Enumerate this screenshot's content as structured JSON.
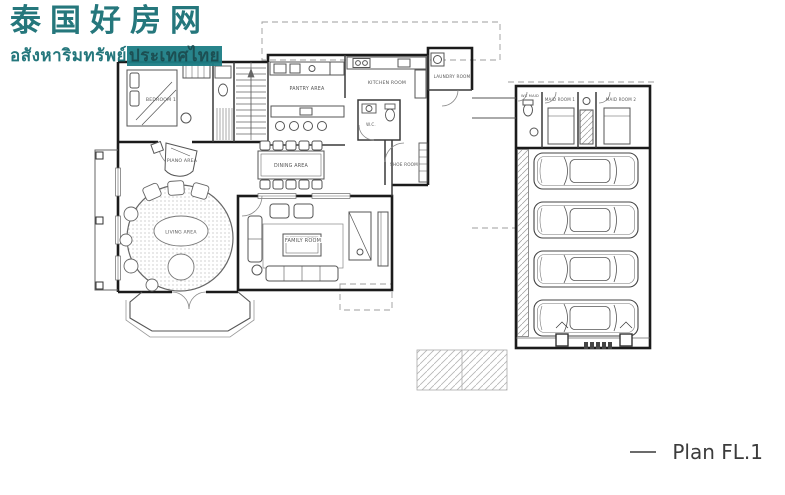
{
  "watermark": {
    "title_cn": "泰国好房网",
    "subtitle_th_plain": "อสังหาริมทรัพย์",
    "subtitle_th_highlight": "ประเทศไทย"
  },
  "colors": {
    "accent_teal": "#1a7076",
    "wall_line": "#1b1b1b",
    "room_label": "#555555"
  },
  "plan": {
    "label": "Plan FL.1",
    "rooms": {
      "bedroom": "BEDROOM 1",
      "pantry": "PANTRY AREA",
      "kitchen": "KITCHEN ROOM",
      "laundry": "LAUNDRY ROOM",
      "bath": "W.C.",
      "shoe": "SHOE ROOM",
      "wc_maid": "WC MAID",
      "maid1": "MAID ROOM 1",
      "maid2": "MAID ROOM 2",
      "dining": "DINING AREA",
      "piano": "PIANO AREA",
      "living": "LIVING AREA",
      "family": "FAMILY ROOM"
    },
    "garage_car_count": "4"
  }
}
